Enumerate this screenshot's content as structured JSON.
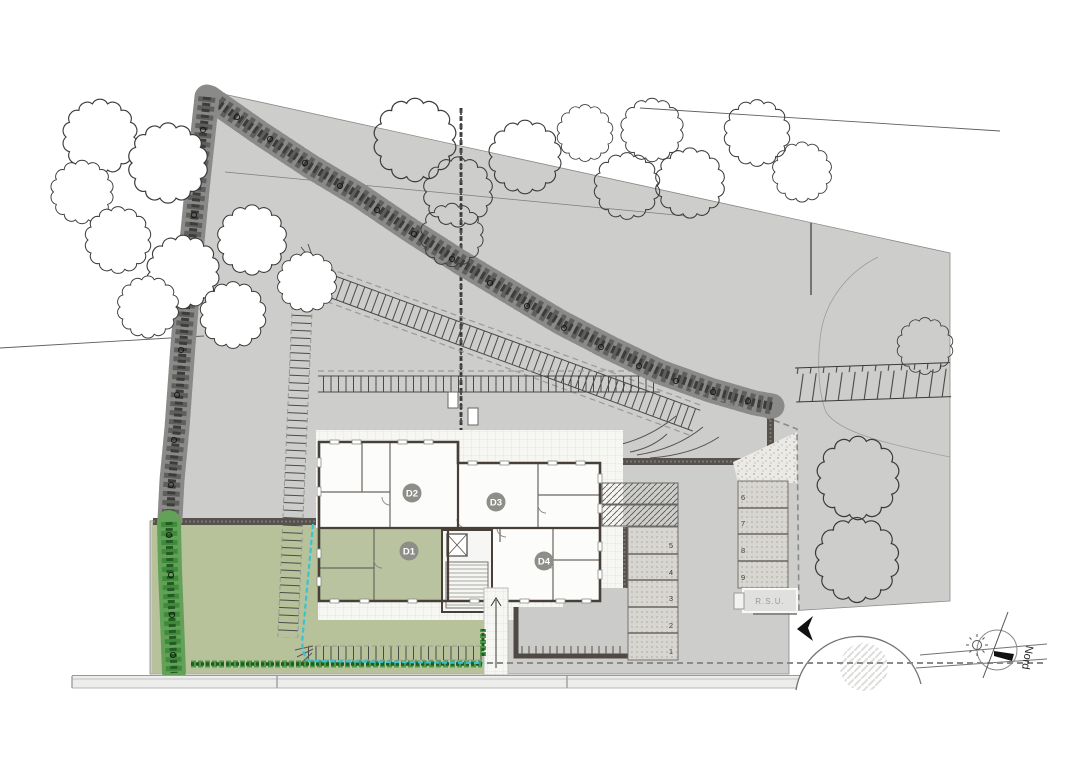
{
  "plan": {
    "units": [
      {
        "id": "D1"
      },
      {
        "id": "D2"
      },
      {
        "id": "D3"
      },
      {
        "id": "D4"
      }
    ],
    "parking": {
      "left_stalls": [
        "5",
        "4",
        "3",
        "2",
        "1"
      ],
      "right_stalls": [
        "6",
        "7",
        "8",
        "9"
      ]
    },
    "rsu_label": "R.S.U.",
    "compass_label": "Nord"
  },
  "colors": {
    "site": "#cdcdcb",
    "lawn": "#b7c29b",
    "unit_green": "#b9c3a0",
    "badge": "#8e8e89",
    "wall": "#474038",
    "hedge": "#64645f",
    "hedge_green": "#3f8b3b",
    "cyan": "#35c3d5",
    "cobble": "#d8d6d1",
    "road": "#ededeb",
    "tile": "#f6f6f3"
  }
}
